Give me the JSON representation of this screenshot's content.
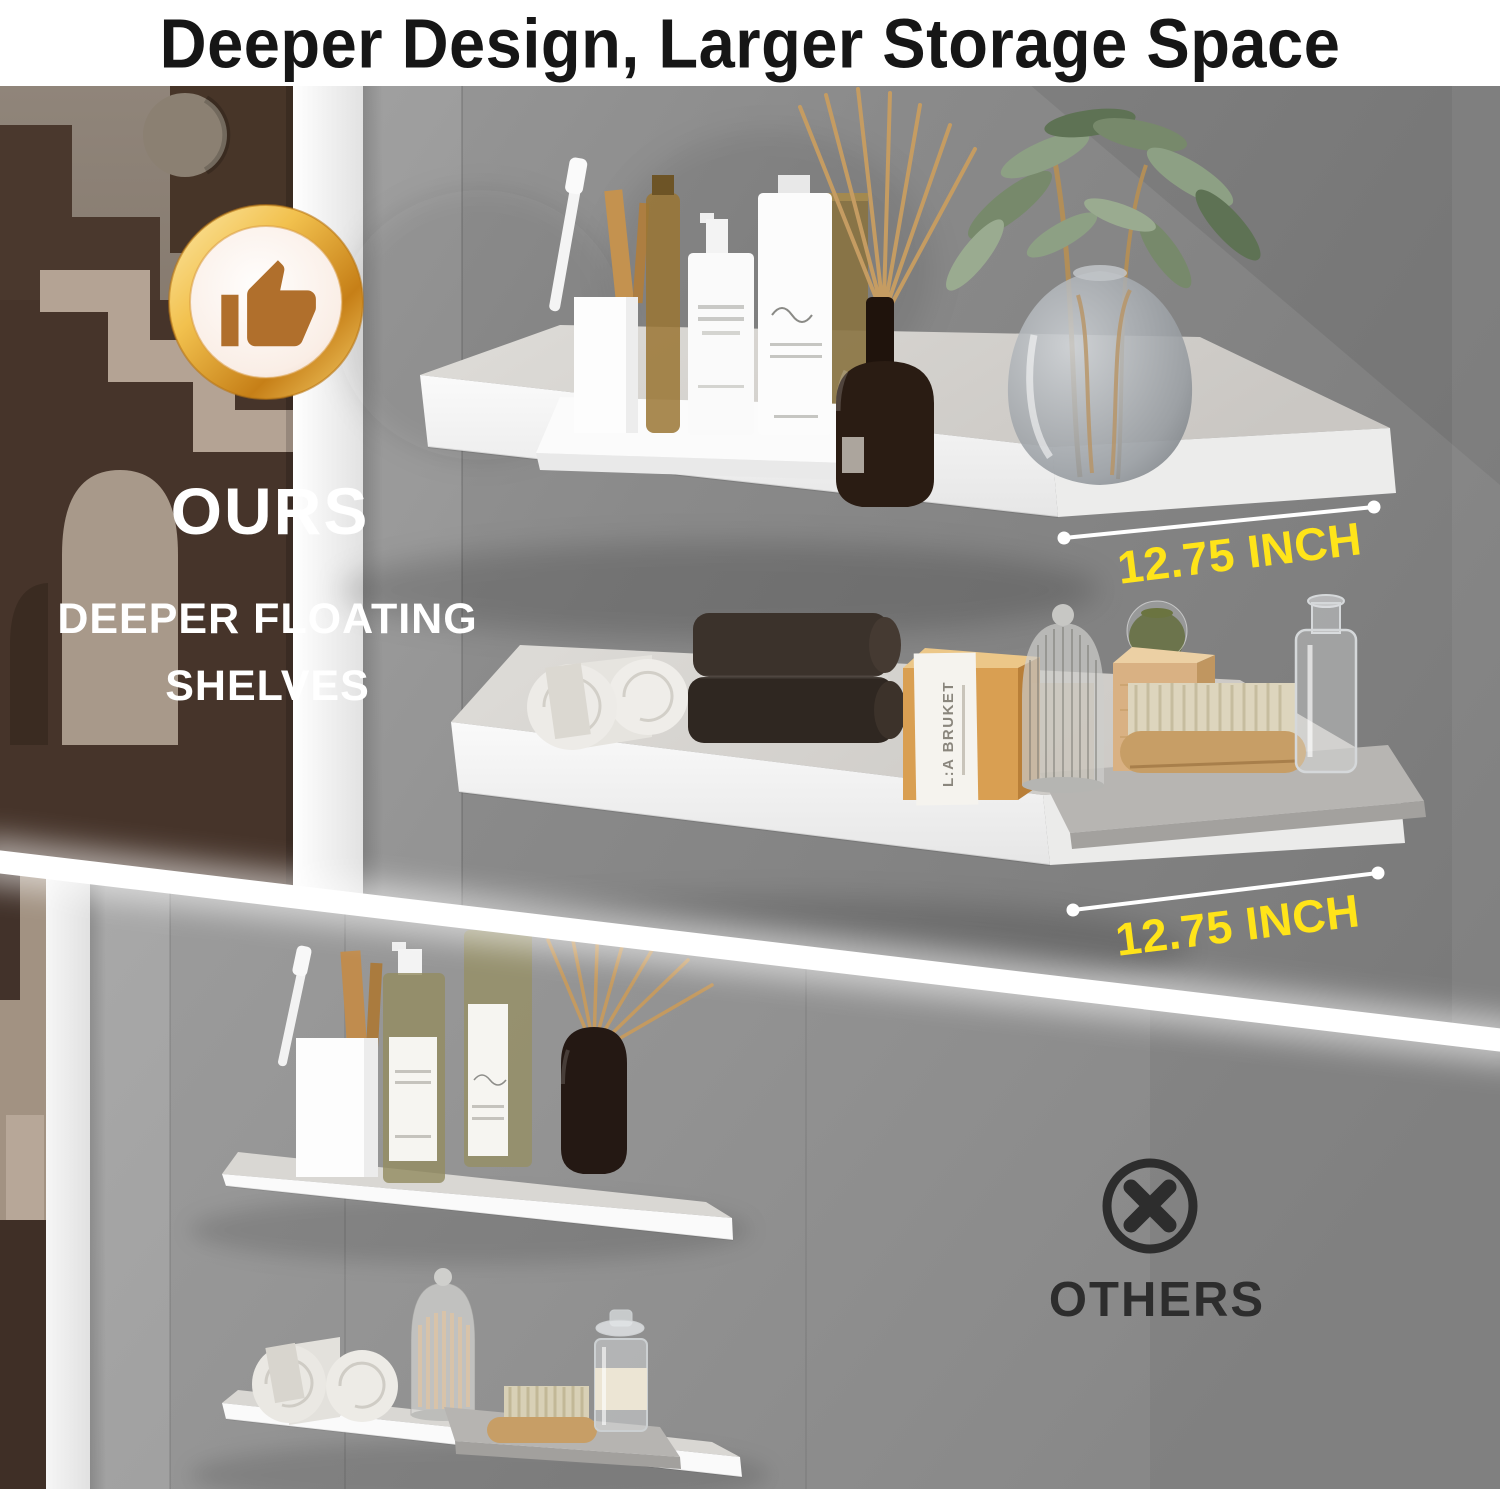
{
  "title": "Deeper Design, Larger Storage Space",
  "ours_section": {
    "heading": "OURS",
    "subheading_line1": "DEEPER FLOATING",
    "subheading_line2": "SHELVES",
    "depth_label_top": "12.75 INCH",
    "depth_label_bottom": "12.75 INCH",
    "badge_icon": "thumbs-up-icon"
  },
  "others_section": {
    "heading": "OTHERS",
    "mark_icon": "circled-x-icon"
  },
  "props": {
    "soap_brand": "L:A BRUKET"
  },
  "colors": {
    "accent_yellow": "#FFE419",
    "title_text": "#161616",
    "others_text": "#2D2D2D",
    "badge_gold": "#E9A23C",
    "wall_gray_ours": "#8C8C8C",
    "wall_gray_others": "#979797",
    "shelf_white": "#F4F4F4"
  }
}
